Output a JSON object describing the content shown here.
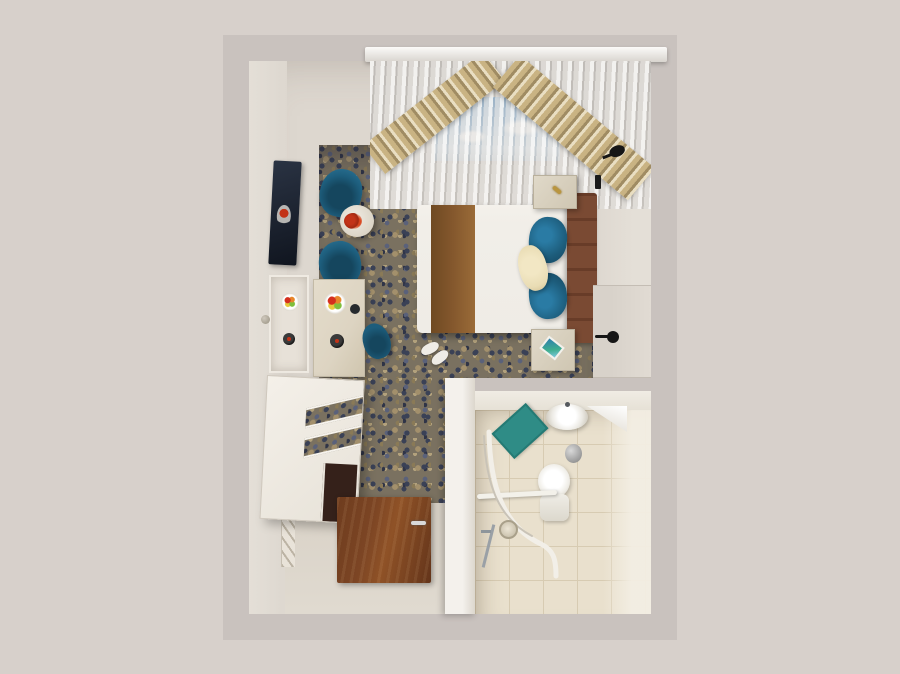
{
  "scene": {
    "type": "3d-top-down-render",
    "subject": "hotel guest room with ensuite bathroom, viewed from directly above",
    "colors": {
      "bg": "#d7d0cb",
      "wall-top": "#c9c2be",
      "plaster": "#ddd7cf",
      "plaster-light": "#e4dfd7",
      "corridor-floor": "#d9d2c7",
      "carpet-base": "#7a7160",
      "carpet-navy": "#3a4156",
      "carpet-blue": "#5a617a",
      "carpet-tan": "#a3906c",
      "carpet-brown": "#8a7a57",
      "carpet-dark": "#2f3447",
      "carpet-light": "#b2a17c",
      "teal": "#1d5d7c",
      "teal-dark": "#15465e",
      "runner-brown": "#82562c",
      "headboard-brown": "#7a4a33",
      "wood-door": "#7c4524",
      "mattress": "#f1eee8",
      "cream-pillow": "#e9dcb4",
      "marble": "#ddd4c2",
      "sky-top": "#8fb6d9",
      "sky-bottom": "#d7e4ee",
      "drape-beige1": "#c9b383",
      "drape-beige2": "#a08c63",
      "drape-beige3": "#e9dec2",
      "tile": "#e9e0cd",
      "tile-line": "#d7cbb2",
      "mat-teal": "#2f8c86",
      "bin-grey": "#7f7f7f",
      "red": "#c23318",
      "black": "#161616"
    },
    "bedroom_items": [
      "double bed",
      "brown bed runner",
      "two teal pillows",
      "cream accent pillow",
      "channel-tufted headboard",
      "nightstand with gold key",
      "nightstand with teal book",
      "two black wall reading lamps",
      "two teal armchairs",
      "round marble side table",
      "red flower arrangement",
      "wall-mounted tv",
      "vanity mirror",
      "marble desk with fruit plate and wine bottle",
      "teal desk chair",
      "white dresser with open shelves",
      "dark minibar cabinet",
      "white slippers",
      "patterned blue-brown carpet",
      "sheer curtain with sky window",
      "beige slat drapes",
      "white cornice rail",
      "wooden entry door with steel handle",
      "side door with black lever handle",
      "wall outlets"
    ],
    "bathroom_items": [
      "white washbasin",
      "corner shelf",
      "teal bath mat",
      "stainless waste bin",
      "toilet",
      "curved shower rail",
      "hand shower set",
      "grab bar",
      "beige tiled floor"
    ]
  }
}
